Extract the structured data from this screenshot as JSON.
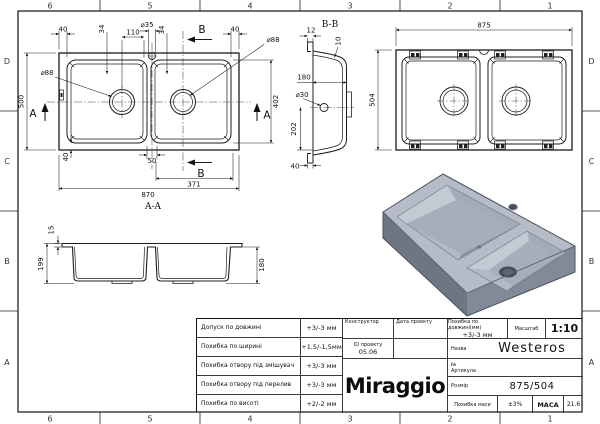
{
  "frame": {
    "columns": [
      "6",
      "5",
      "4",
      "3",
      "2",
      "1"
    ],
    "rows": [
      "D",
      "C",
      "B",
      "A"
    ]
  },
  "drawing": {
    "top_view": {
      "dim_40_tl": "40",
      "dim_34_l": "34",
      "dim_110": "110",
      "dim_d35": "⌀35",
      "dim_34_r": "34",
      "dim_40_tr": "40",
      "dim_d88_r": "⌀88",
      "dim_d88_l": "⌀88",
      "dim_500": "500",
      "dim_402": "402",
      "dim_40_b": "40",
      "dim_50": "50",
      "dim_371": "371",
      "dim_870": "870",
      "cut_a": "A",
      "cut_b": "B",
      "section_label": "A-A"
    },
    "section_aa": {
      "dim_15": "15",
      "dim_199": "199",
      "dim_180": "180"
    },
    "section_bb": {
      "title": "B-B",
      "dim_12": "12",
      "dim_10": "10",
      "dim_180": "180",
      "dim_d30": "⌀30",
      "dim_202": "202",
      "dim_40": "40"
    },
    "bottom_view": {
      "dim_875": "875",
      "dim_504": "504"
    }
  },
  "title_block": {
    "tolerances": [
      {
        "label": "Допуск по довжині",
        "value": "+3/-3 мм"
      },
      {
        "label": "Похибка по ширині",
        "value": "+1,5/-1,5мм"
      },
      {
        "label": "Похибка отвору під змішувач",
        "value": "+3/-3 мм"
      },
      {
        "label": "Похибка отвору під перелив",
        "value": "+3/-3 мм"
      },
      {
        "label": "Похибка по висоті",
        "value": "+2/-2 мм"
      }
    ],
    "constructor_label": "Конструктор",
    "date_label": "Дата проекту",
    "project_id_label": "ID проекту",
    "project_id_value": "05.06",
    "length_tol_label": "Похибка по довжині(мм)",
    "length_tol_value": "+3/-3 мм",
    "scale_label": "Масштаб",
    "scale_value": "1:10",
    "name_label": "Назва",
    "name_value": "Westeros",
    "article_label": "№ Артикула",
    "size_label": "Розмір",
    "size_value": "875/504",
    "mass_tol_label": "Похибка маси",
    "mass_tol_value": "±3%",
    "mass_label": "МАСА",
    "mass_value": "21.6",
    "logo": "Miraggio"
  },
  "colors": {
    "line": "#1c1c1c",
    "sink_top": "#b6bcc7",
    "sink_side_dark": "#6e7684",
    "sink_side_mid": "#828a98"
  }
}
